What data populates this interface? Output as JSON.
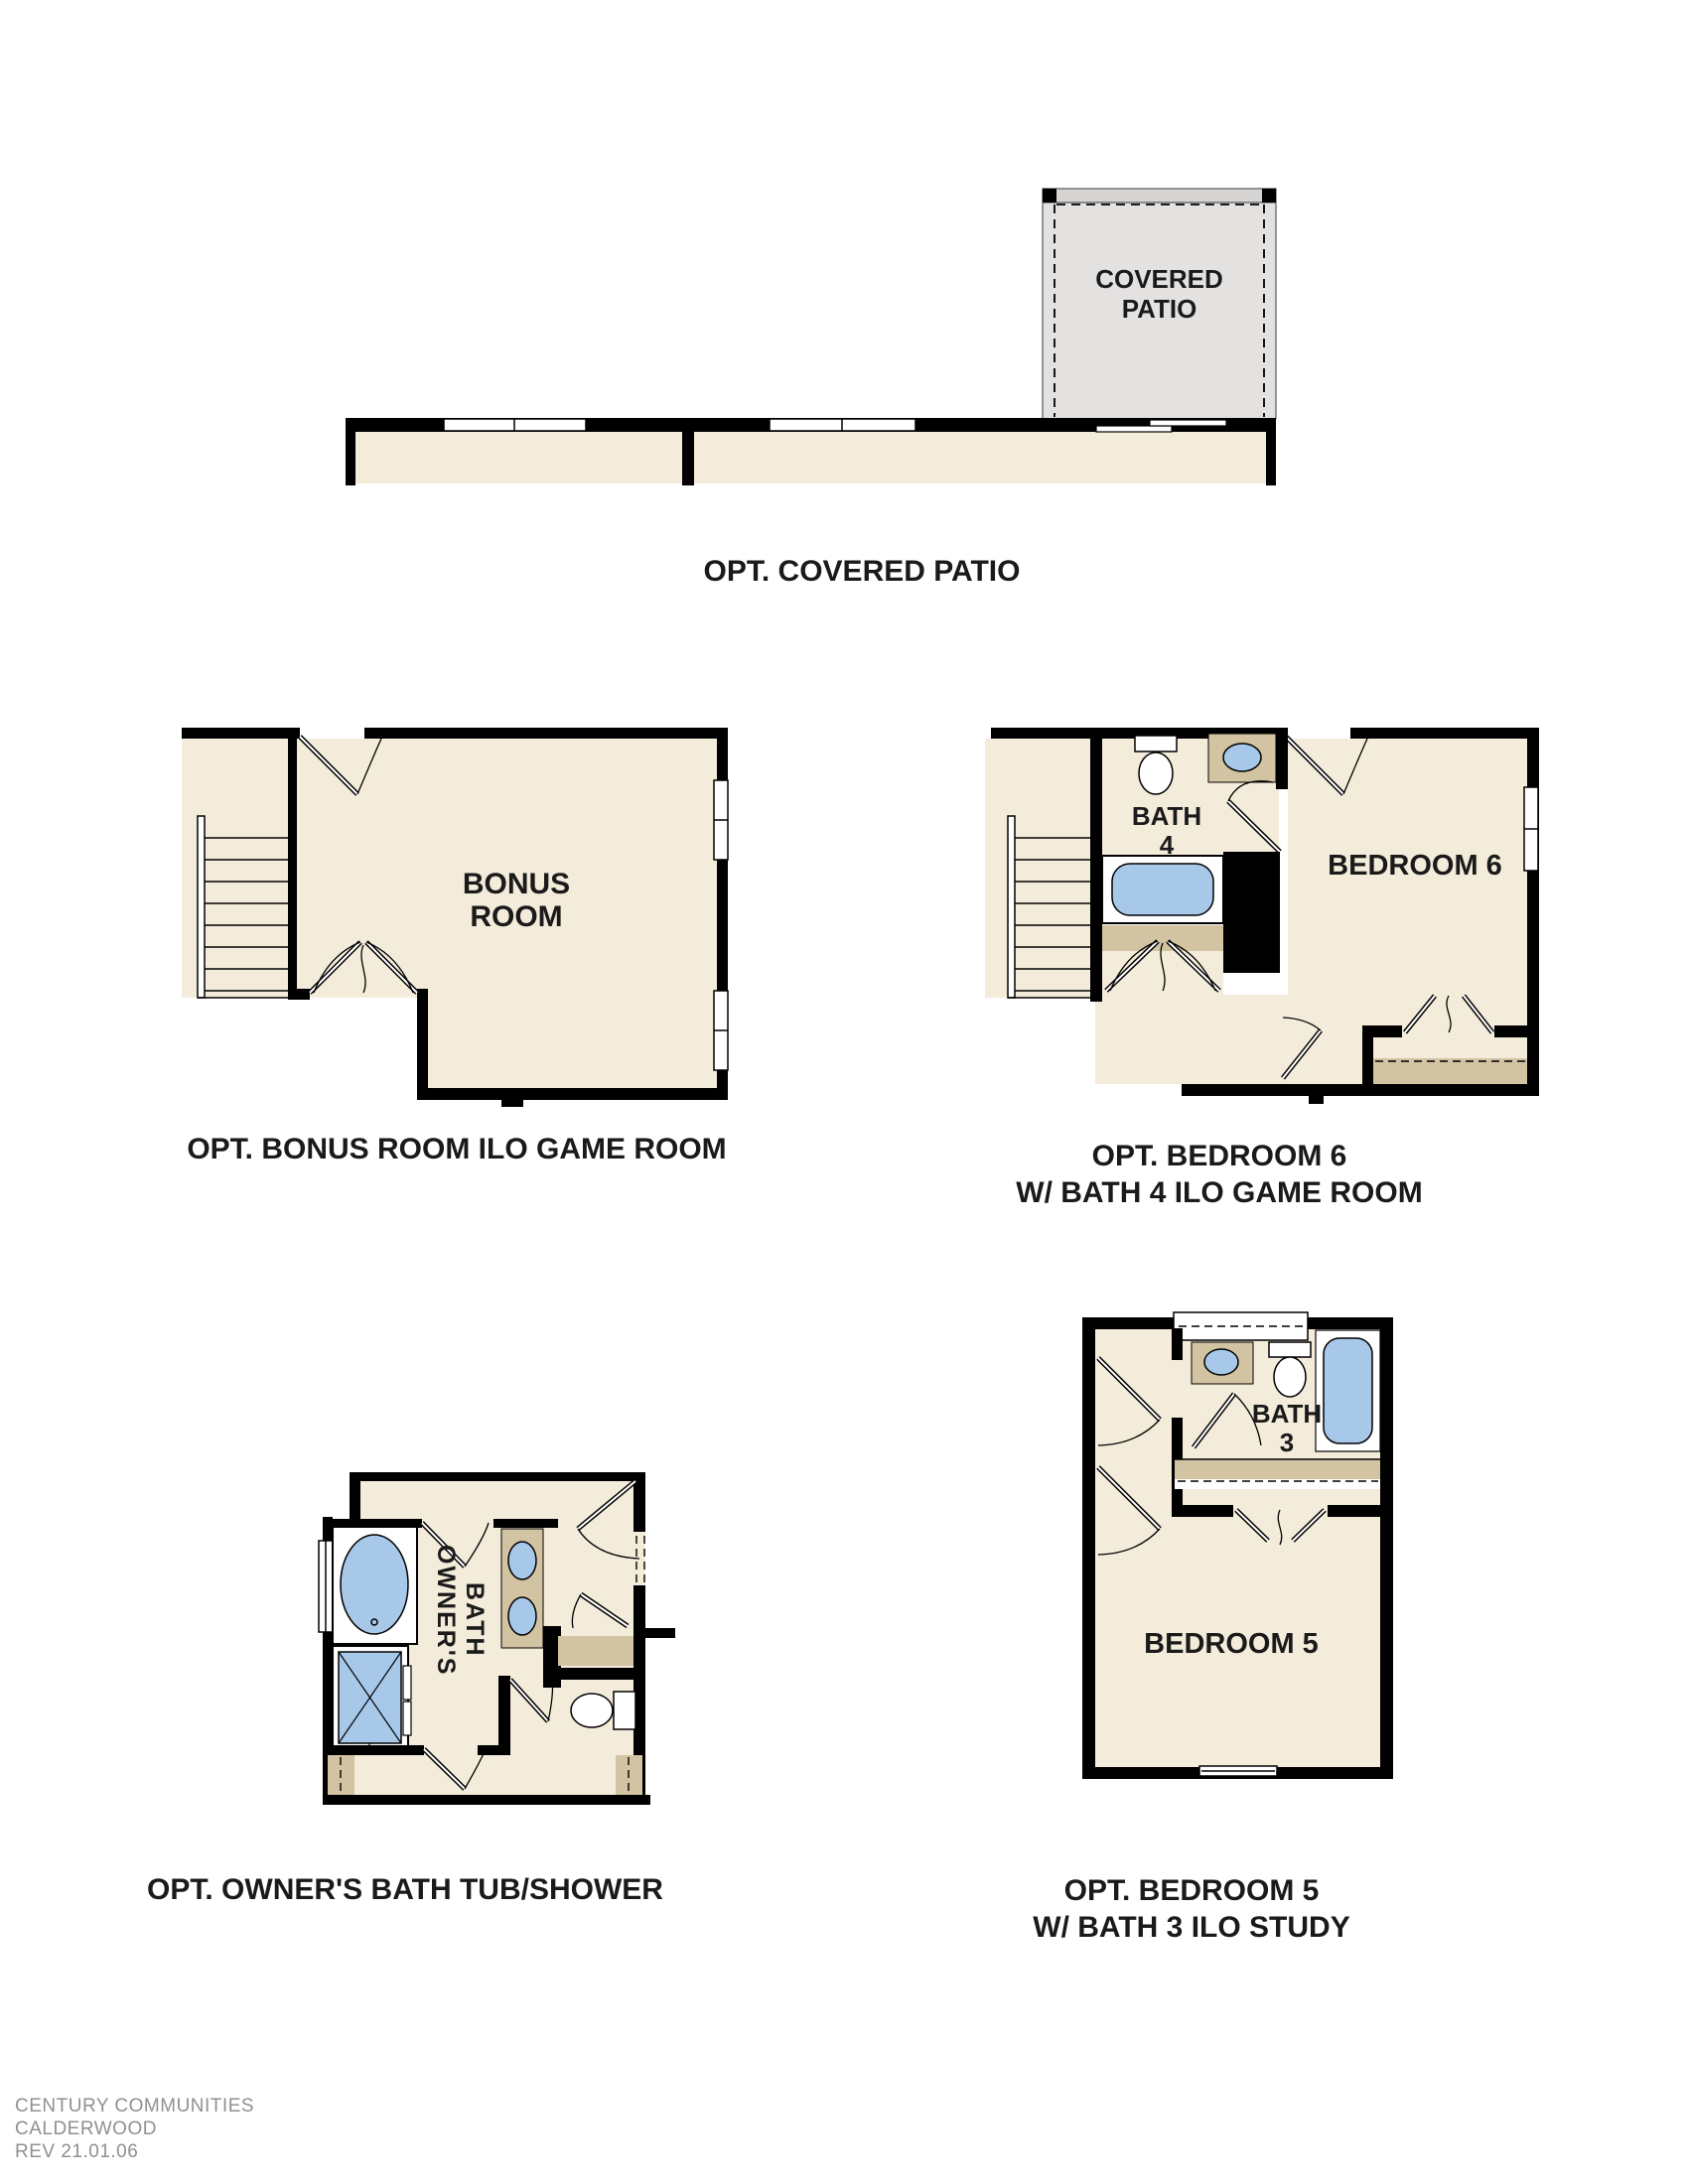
{
  "plans": {
    "covered_patio": {
      "room_label_line1": "COVERED",
      "room_label_line2": "PATIO",
      "caption": "OPT. COVERED PATIO"
    },
    "bonus_room": {
      "room_label_line1": "BONUS",
      "room_label_line2": "ROOM",
      "caption": "OPT. BONUS ROOM ILO GAME ROOM"
    },
    "bedroom6": {
      "room_label": "BEDROOM 6",
      "bath_label_line1": "BATH",
      "bath_label_line2": "4",
      "caption_line1": "OPT. BEDROOM 6",
      "caption_line2": "W/ BATH 4 ILO GAME ROOM"
    },
    "owners_bath": {
      "room_label_line1": "OWNER'S",
      "room_label_line2": "BATH",
      "caption": "OPT. OWNER'S BATH TUB/SHOWER"
    },
    "bedroom5": {
      "room_label": "BEDROOM 5",
      "bath_label_line1": "BATH",
      "bath_label_line2": "3",
      "caption_line1": "OPT. BEDROOM 5",
      "caption_line2": "W/ BATH 3 ILO STUDY"
    }
  },
  "footer": {
    "line1": "CENTURY COMMUNITIES",
    "line2": "CALDERWOOD",
    "line3": "REV 21.01.06"
  },
  "colors": {
    "wall": "#000000",
    "floor_beige": "#f4ecdb",
    "accent_tan": "#d2c3a2",
    "fixture_blue": "#a8c8ea",
    "patio_gray": "#e4e2e1",
    "caption_text": "#1a1a1a",
    "footer_gray": "#909090"
  }
}
